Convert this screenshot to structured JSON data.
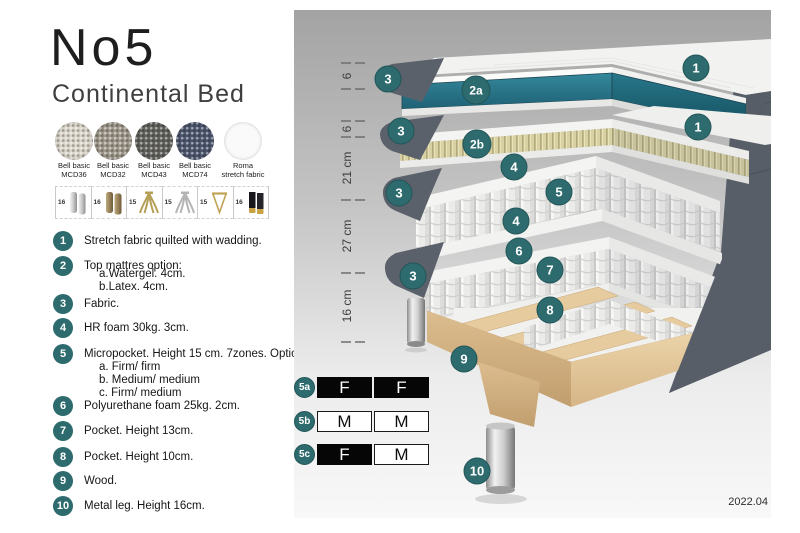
{
  "page": {
    "title": "No5",
    "subtitle": "Continental Bed",
    "version": "2022.04"
  },
  "colors": {
    "accent_teal": "#2E6B6E",
    "side_gray": "#5A616B",
    "topper_teal": "#2A7D91",
    "latex_khaki": "#D8D1A4",
    "wood": "#E3C99E",
    "swatch_mcd36": "#DBD6CB",
    "swatch_mcd32": "#9E978B",
    "swatch_mcd43": "#61615E",
    "swatch_mcd74": "#4C566F",
    "swatch_roma": "#FAFAFA"
  },
  "swatches": [
    {
      "line1": "Bell basic",
      "line2": "MCD36"
    },
    {
      "line1": "Bell basic",
      "line2": "MCD32"
    },
    {
      "line1": "Bell basic",
      "line2": "MCD43"
    },
    {
      "line1": "Bell basic",
      "line2": "MCD74"
    },
    {
      "line1": "Roma",
      "line2": "stretch fabric"
    }
  ],
  "leg_options": [
    {
      "height": "16"
    },
    {
      "height": "16"
    },
    {
      "height": "15"
    },
    {
      "height": "15"
    },
    {
      "height": "15"
    },
    {
      "height": "16"
    }
  ],
  "legend": [
    {
      "num": "1",
      "text": "Stretch fabric quilted with wadding."
    },
    {
      "num": "2",
      "text": "Top mattres option:",
      "sub": [
        "a.Watergel. 4cm.",
        "b.Latex. 4cm."
      ]
    },
    {
      "num": "3",
      "text": "Fabric."
    },
    {
      "num": "4",
      "text": "HR foam 30kg. 3cm."
    },
    {
      "num": "5",
      "text": "Micropocket. Height 15 cm. 7zones. Option:",
      "sub": [
        "a. Firm/ firm",
        "b. Medium/ medium",
        "c. Firm/ medium"
      ]
    },
    {
      "num": "6",
      "text": "Polyurethane foam 25kg. 2cm."
    },
    {
      "num": "7",
      "text": "Pocket. Height 13cm."
    },
    {
      "num": "8",
      "text": "Pocket. Height 10cm."
    },
    {
      "num": "9",
      "text": "Wood."
    },
    {
      "num": "10",
      "text": "Metal leg. Height 16cm."
    }
  ],
  "diagram": {
    "ruler": [
      "6",
      "6",
      "21 cm",
      "27 cm",
      "16 cm"
    ],
    "callouts": {
      "layer1_fabric": "3",
      "layer1_topper_watergel": "2a",
      "layer1_stretch": "1",
      "layer2_fabric": "3",
      "layer2_topper_latex": "2b",
      "layer2_stretch": "1",
      "layer3_hr_top": "4",
      "layer3_micropocket": "5",
      "layer3_fabric": "3",
      "layer3_hr_bottom": "4",
      "layer4_pu": "6",
      "layer4_pocket13": "7",
      "layer4_fabric": "3",
      "layer4_pocket10": "8",
      "base_wood": "9",
      "metal_leg": "10"
    }
  },
  "firmness": {
    "rows": [
      {
        "id": "5a",
        "cells": [
          {
            "value": "F",
            "dark": true
          },
          {
            "value": "F",
            "dark": true
          }
        ]
      },
      {
        "id": "5b",
        "cells": [
          {
            "value": "M",
            "dark": false
          },
          {
            "value": "M",
            "dark": false
          }
        ]
      },
      {
        "id": "5c",
        "cells": [
          {
            "value": "F",
            "dark": true
          },
          {
            "value": "M",
            "dark": false
          }
        ]
      }
    ]
  }
}
